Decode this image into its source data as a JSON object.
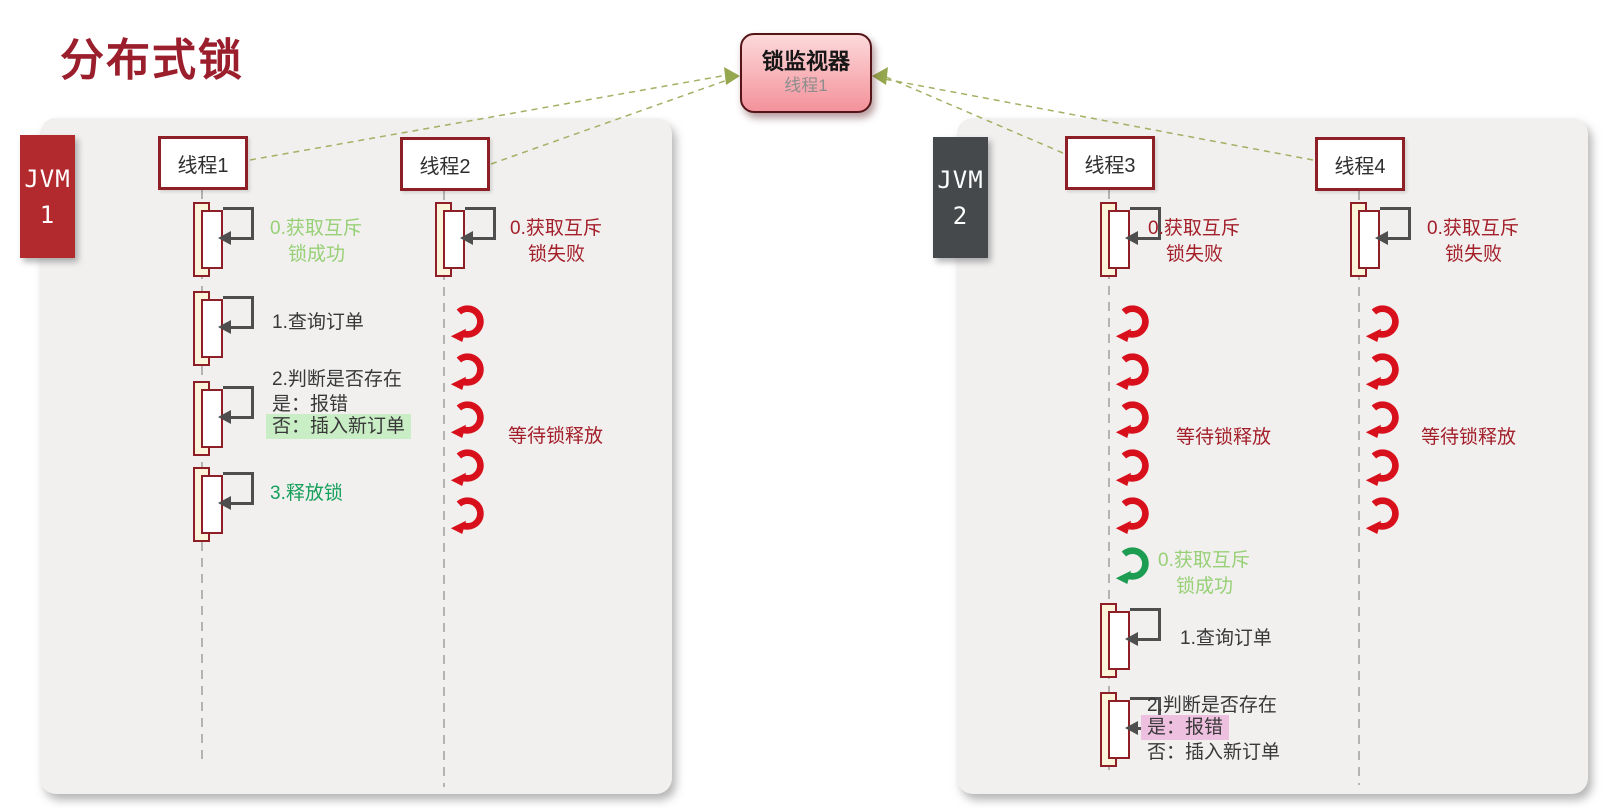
{
  "title": "分布式锁",
  "colors": {
    "title_red": "#9b1e2d",
    "jvm1_red": "#b22a2e",
    "jvm2_gray": "#45494b",
    "box_border_red": "#8e1f26",
    "annotation_red": "#a31f2a",
    "light_green": "#98d077",
    "green": "#17a05c",
    "retry_arrow_red": "#d8101c",
    "retry_arrow_green": "#1d9d52",
    "highlight_green": "#c9edc4",
    "highlight_pink": "#eec0df",
    "monitor_pink_top": "#fcd9da",
    "monitor_pink_bottom": "#f4929b",
    "connector_olive": "#a3b164",
    "panel_gray": "#f1f0ef"
  },
  "monitor": {
    "title": "锁监视器",
    "subtitle": "线程1"
  },
  "jvm1": {
    "label_line1": "JVM",
    "label_line2": "1",
    "thread1": {
      "name": "线程1",
      "step0_line1": "0.获取互斥",
      "step0_line2": "锁成功",
      "step1": "1.查询订单",
      "step2_line1": "2.判断是否存在",
      "step2_line2": "是：报错",
      "step2_line3": "否：插入新订单",
      "step3": "3.释放锁"
    },
    "thread2": {
      "name": "线程2",
      "step0_line1": "0.获取互斥",
      "step0_line2": "锁失败",
      "wait_label": "等待锁释放"
    }
  },
  "jvm2": {
    "label_line1": "JVM",
    "label_line2": "2",
    "thread3": {
      "name": "线程3",
      "step0_line1": "0.获取互斥",
      "step0_line2": "锁失败",
      "wait_label": "等待锁释放",
      "acquired_line1": "0.获取互斥",
      "acquired_line2": "锁成功",
      "step1": "1.查询订单",
      "step2_line1": "2.判断是否存在",
      "step2_line2": "是：报错",
      "step2_line3": "否：插入新订单"
    },
    "thread4": {
      "name": "线程4",
      "step0_line1": "0.获取互斥",
      "step0_line2": "锁失败",
      "wait_label": "等待锁释放"
    }
  }
}
